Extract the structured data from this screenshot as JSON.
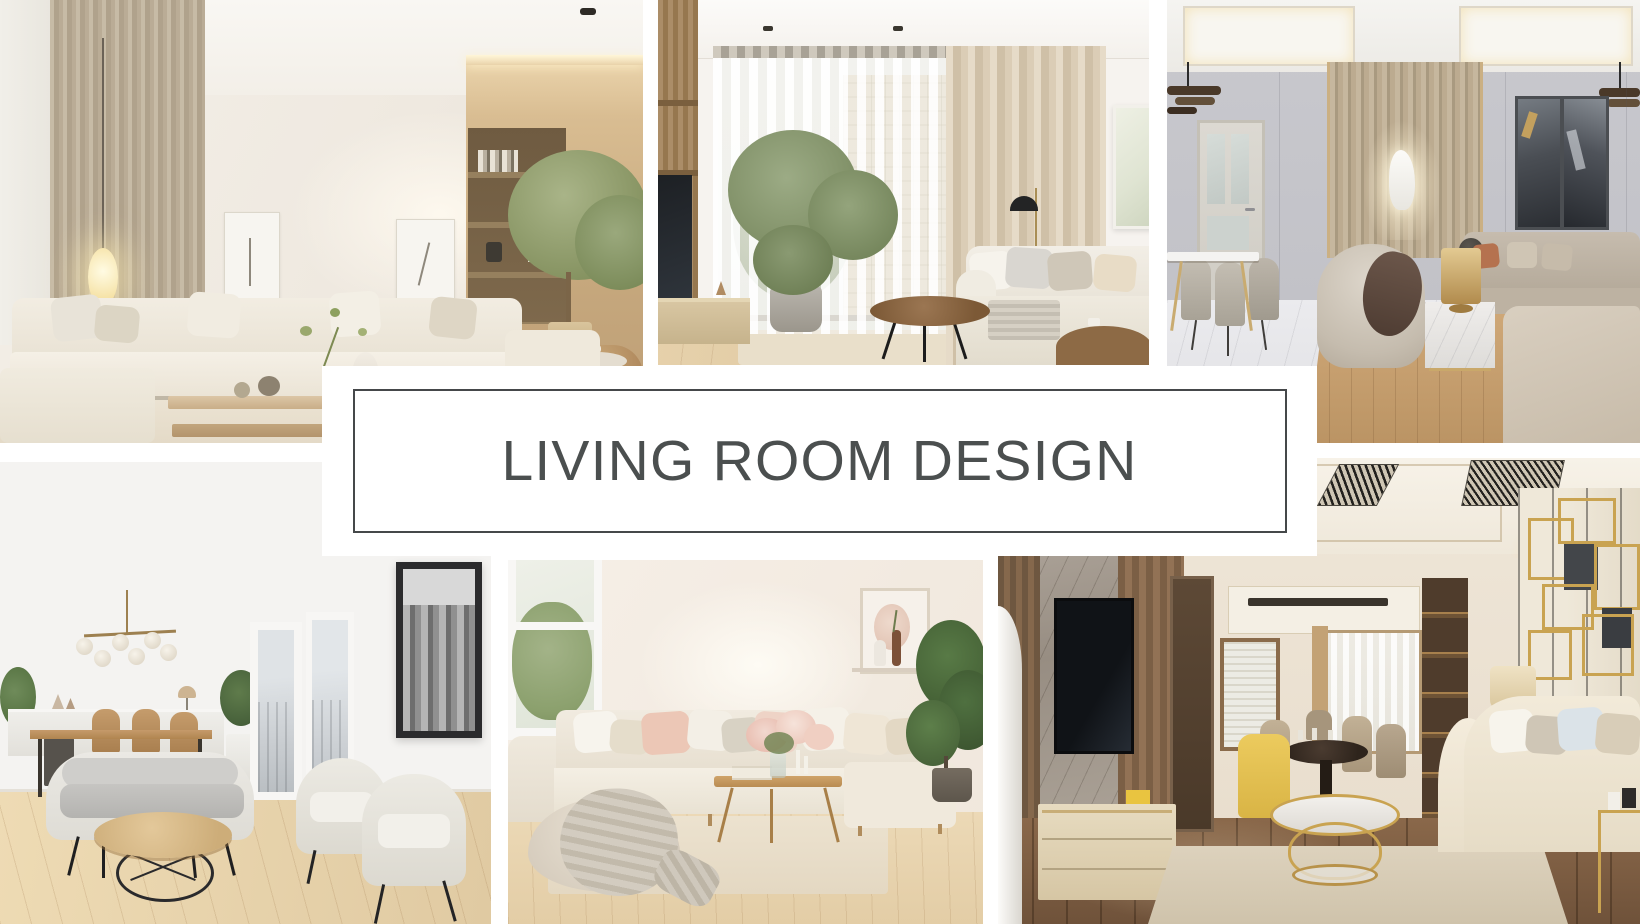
{
  "banner": {
    "title": "LIVING ROOM DESIGN",
    "title_color": "#4b4f4f",
    "frame_border_color": "#45484a",
    "background": "#ffffff"
  },
  "collage": {
    "background": "#ffffff",
    "photos": [
      {
        "id": "top-left",
        "label": "Bright beige living room with cream modular sectional sofa, glowing floor lamp, layered wood coffee table, built-in wooden shelving and indoor tree"
      },
      {
        "id": "top-middle",
        "label": "Living room with sheer window curtains, tall beige drapes, potted tree, wooden media unit, black dome floor lamp and round dark wood coffee table beside a cream sofa"
      },
      {
        "id": "top-right",
        "label": "Elegant greige lounge with marble dining table and upholstered chairs, striped feature wall with lit sculpture niche, dark abstract art pair, curved armchair and gold lamp on marble cube side table"
      },
      {
        "id": "bottom-left",
        "label": "Scandinavian open living-dining room with brass globe chandelier, white sideboard, wood dining set, gray loveseat, round wood coffee table on black wire base, two cream armchairs, city-view windows and black-framed city photograph"
      },
      {
        "id": "bottom-middle",
        "label": "Cozy bright living room with cream corner sofa, blush and beige cushions, chunky knit throw over a pouf, slim wood coffee table with pink flowers, wall shelf with art and a potted plant"
      },
      {
        "id": "bottom-right",
        "label": "Warm modern living room with marble and wood TV wall, cream media console, dining nook with yellow accent chair, round gold coffee table with marble top, cream sofa and gold geometric wall art"
      }
    ]
  }
}
